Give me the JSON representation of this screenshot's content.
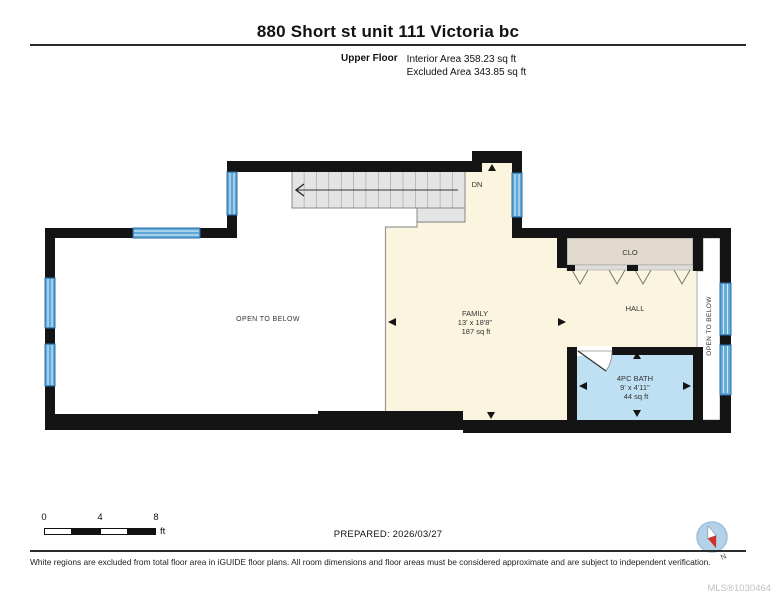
{
  "header": {
    "title": "880 Short st unit 111 Victoria bc",
    "floor": "Upper Floor",
    "interior_area": "Interior Area 358.23 sq ft",
    "excluded_area": "Excluded Area 343.85 sq ft"
  },
  "plan": {
    "rooms": {
      "family": {
        "name": "FAMILY",
        "dims": "13' x 18'8\"",
        "area": "187 sq ft"
      },
      "bath": {
        "name": "4PC BATH",
        "dims": "9' x 4'11\"",
        "area": "44 sq ft"
      },
      "hall": {
        "name": "HALL"
      },
      "closet": {
        "name": "CLO"
      },
      "stairs": {
        "label": "DN"
      },
      "open_below_left": {
        "name": "OPEN TO BELOW"
      },
      "open_below_right": {
        "name": "OPEN TO BELOW"
      }
    },
    "colors": {
      "wall": "#141414",
      "room_fill": "#FBF4DE",
      "bath_fill": "#BFE0F2",
      "closet_fill": "#E2DACC",
      "stair_fill": "#E4E4E4",
      "window_blue": "#5FA8D8",
      "compass_fill": "#B3D2E9",
      "compass_red": "#D03028"
    }
  },
  "scale_bar": {
    "ticks": [
      "0",
      "4",
      "8"
    ],
    "unit": "ft"
  },
  "footer": {
    "prepared": "PREPARED: 2026/03/27",
    "disclaimer": "White regions are excluded from total floor area in iGUIDE floor plans. All room dimensions and floor areas must be considered approximate and are subject to independent verification.",
    "mls": "MLS®1030464",
    "compass_n": "N"
  }
}
